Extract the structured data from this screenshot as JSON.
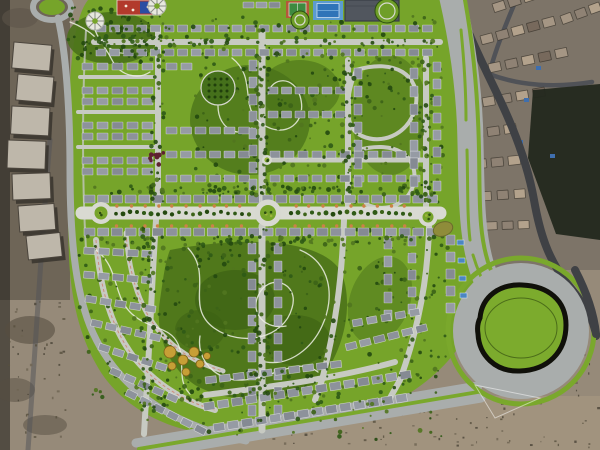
{
  "meta": {
    "subject": "Aerial masterplan rendering of a gated residential compound over desert satellite imagery",
    "canvas": {
      "w": 600,
      "h": 450
    }
  },
  "palette": {
    "sand": "#968a79",
    "sand-dark": "#6e6557",
    "sand-light": "#a3947f",
    "asphalt": "#3f4145",
    "satroad": "#505257",
    "plan": "#76a42a",
    "plan-dark": "#4a7119",
    "plan-darker": "#3c6114",
    "verge": "#7aa82c",
    "road": "#a9adac",
    "street": "#c7cac2",
    "blvd": "#d9dad2",
    "building": "#8d929b",
    "pool-blue": "#4b86c2",
    "court-green": "#3e8a40",
    "court-clay": "#b4583a",
    "playground-red": "#b23a2c",
    "playground-blue": "#2b4ea2",
    "golden-tree": "#c79f36",
    "maroon-tree": "#5f2130",
    "pond-khaki": "#8f8c3a",
    "island-outline": "#10100a",
    "clubhouse": "#51565e"
  },
  "map": {
    "regions": [
      "desert-satellite-backdrop",
      "existing-buildings-west",
      "existing-neighborhood-northeast",
      "masterplan-compound",
      "perimeter-ring-road",
      "east-access-road",
      "main-boulevard",
      "west-roundabout",
      "central-roundabout",
      "east-roundabout",
      "grand-roundabout-southeast",
      "bottom-boulevard",
      "north-park",
      "central-park",
      "southwest-park",
      "sports-courts",
      "playground",
      "clubhouse",
      "residential-block-rows"
    ],
    "building_fills": [
      "#8d929b",
      "#969ba4",
      "#858a93"
    ],
    "sat_house_fills": [
      "#a59684",
      "#8f8274",
      "#b3a28c",
      "#77695c"
    ],
    "tree_colors": [
      "#24490f",
      "#2f5a16",
      "#3c6317",
      "#51751f"
    ],
    "speckle_colors": [
      "#57503f",
      "#6e6452",
      "#4a4437"
    ],
    "building_rows": [
      {
        "x": 96,
        "y": 25,
        "n": 25,
        "dx": 13.6,
        "w": 10,
        "h": 7
      },
      {
        "x": 96,
        "y": 49,
        "n": 25,
        "dx": 13.6,
        "w": 10,
        "h": 7
      },
      {
        "x": 243,
        "y": 2,
        "n": 3,
        "dx": 13,
        "w": 11,
        "h": 6
      },
      {
        "x": 82,
        "y": 63,
        "n": 5,
        "dx": 15,
        "w": 11,
        "h": 7
      },
      {
        "x": 82,
        "y": 87,
        "n": 5,
        "dx": 15,
        "w": 11,
        "h": 7
      },
      {
        "x": 82,
        "y": 98,
        "n": 5,
        "dx": 15,
        "w": 11,
        "h": 7
      },
      {
        "x": 82,
        "y": 122,
        "n": 5,
        "dx": 15,
        "w": 11,
        "h": 7
      },
      {
        "x": 82,
        "y": 133,
        "n": 5,
        "dx": 15,
        "w": 11,
        "h": 7
      },
      {
        "x": 82,
        "y": 157,
        "n": 5,
        "dx": 15,
        "w": 11,
        "h": 7
      },
      {
        "x": 82,
        "y": 168,
        "n": 5,
        "dx": 15,
        "w": 11,
        "h": 7
      },
      {
        "x": 166,
        "y": 63,
        "n": 2,
        "dx": 15,
        "w": 11,
        "h": 7
      },
      {
        "x": 166,
        "y": 127,
        "n": 6,
        "dx": 14.5,
        "w": 11,
        "h": 7
      },
      {
        "x": 166,
        "y": 151,
        "n": 6,
        "dx": 14.5,
        "w": 11,
        "h": 7
      },
      {
        "x": 166,
        "y": 175,
        "n": 6,
        "dx": 14.5,
        "w": 11,
        "h": 7
      },
      {
        "x": 268,
        "y": 87,
        "n": 6,
        "dx": 13.5,
        "w": 10,
        "h": 7
      },
      {
        "x": 268,
        "y": 111,
        "n": 6,
        "dx": 13.5,
        "w": 10,
        "h": 7
      },
      {
        "x": 270,
        "y": 151,
        "n": 11,
        "dx": 14,
        "w": 10,
        "h": 7
      },
      {
        "x": 270,
        "y": 175,
        "n": 11,
        "dx": 14,
        "w": 10,
        "h": 7
      },
      {
        "x": 249,
        "y": 60,
        "n": 8,
        "dy": 17,
        "w": 8,
        "h": 11
      },
      {
        "x": 354,
        "y": 68,
        "n": 7,
        "dy": 18,
        "w": 8,
        "h": 11
      },
      {
        "x": 410,
        "y": 68,
        "n": 7,
        "dy": 18,
        "w": 8,
        "h": 11
      },
      {
        "x": 433,
        "y": 62,
        "n": 8,
        "dy": 17,
        "w": 8,
        "h": 10
      },
      {
        "x": 84,
        "y": 195,
        "n": 26,
        "dx": 13.7,
        "w": 11,
        "h": 8
      },
      {
        "x": 84,
        "y": 228,
        "n": 26,
        "dx": 13.7,
        "w": 11,
        "h": 8
      },
      {
        "x": 248,
        "y": 243,
        "n": 10,
        "dy": 18,
        "w": 8,
        "h": 11
      },
      {
        "x": 274,
        "y": 243,
        "n": 10,
        "dy": 18,
        "w": 8,
        "h": 11
      },
      {
        "x": 384,
        "y": 238,
        "n": 5,
        "dy": 18,
        "w": 8,
        "h": 11
      },
      {
        "x": 408,
        "y": 236,
        "n": 5,
        "dy": 17,
        "w": 8,
        "h": 10
      },
      {
        "x": 446,
        "y": 235,
        "n": 5,
        "dy": 17,
        "w": 9,
        "h": 10
      },
      {
        "x": 84,
        "y": 247,
        "n": 5,
        "dx": 14.5,
        "w": 11,
        "h": 7,
        "rot": 3
      },
      {
        "x": 84,
        "y": 271,
        "n": 5,
        "dx": 14.5,
        "w": 11,
        "h": 7,
        "rot": 5
      },
      {
        "x": 86,
        "y": 295,
        "n": 5,
        "dx": 15,
        "w": 11,
        "h": 7,
        "rot": 9
      },
      {
        "x": 92,
        "y": 319,
        "n": 5,
        "dx": 15,
        "w": 11,
        "h": 7,
        "rot": 13
      },
      {
        "x": 100,
        "y": 343,
        "n": 5,
        "dx": 15,
        "w": 11,
        "h": 7,
        "rot": 18
      },
      {
        "x": 112,
        "y": 367,
        "n": 5,
        "dx": 15.5,
        "w": 11,
        "h": 7,
        "rot": 24
      },
      {
        "x": 128,
        "y": 389,
        "n": 6,
        "dx": 15.5,
        "w": 11,
        "h": 7,
        "rot": 27
      },
      {
        "x": 205,
        "y": 377,
        "n": 10,
        "dx": 14,
        "w": 11,
        "h": 7,
        "rot": -7
      },
      {
        "x": 203,
        "y": 403,
        "n": 15,
        "dx": 14.2,
        "w": 11,
        "h": 8,
        "rot": -9
      },
      {
        "x": 213,
        "y": 424,
        "n": 14,
        "dx": 14.2,
        "w": 11,
        "h": 8,
        "rot": -9
      },
      {
        "x": 345,
        "y": 344,
        "n": 6,
        "dx": 14.5,
        "w": 11,
        "h": 7,
        "rot": -14
      },
      {
        "x": 352,
        "y": 320,
        "n": 5,
        "dx": 14.5,
        "w": 10,
        "h": 7,
        "rot": -10
      },
      {
        "x": 492,
        "y": 4,
        "n": 6,
        "dx": 16,
        "w": 12,
        "h": 9,
        "rot": -18,
        "sat": 1
      },
      {
        "x": 480,
        "y": 36,
        "n": 5,
        "dx": 16,
        "w": 12,
        "h": 9,
        "rot": -15,
        "sat": 1
      },
      {
        "x": 488,
        "y": 64,
        "n": 5,
        "dx": 17,
        "w": 12,
        "h": 9,
        "rot": -12,
        "sat": 1
      },
      {
        "x": 482,
        "y": 98,
        "n": 4,
        "dx": 17,
        "w": 12,
        "h": 9,
        "rot": -10,
        "sat": 1
      },
      {
        "x": 560,
        "y": 16,
        "n": 3,
        "dx": 15,
        "w": 11,
        "h": 9,
        "rot": -20,
        "sat": 1
      },
      {
        "x": 470,
        "y": 130,
        "n": 3,
        "dx": 17,
        "w": 12,
        "h": 9,
        "rot": -8,
        "sat": 1
      },
      {
        "x": 474,
        "y": 160,
        "n": 3,
        "dx": 17,
        "w": 12,
        "h": 9,
        "rot": -6,
        "sat": 1
      },
      {
        "x": 480,
        "y": 192,
        "n": 3,
        "dx": 17,
        "w": 11,
        "h": 9,
        "rot": -4,
        "sat": 1
      },
      {
        "x": 486,
        "y": 222,
        "n": 3,
        "dx": 16,
        "w": 11,
        "h": 8,
        "rot": -2,
        "sat": 1
      }
    ],
    "sat_buildings": [
      {
        "x": 14,
        "y": 42,
        "w": 38,
        "h": 26,
        "rot": 5
      },
      {
        "x": 18,
        "y": 74,
        "w": 36,
        "h": 26,
        "rot": 5
      },
      {
        "x": 12,
        "y": 106,
        "w": 38,
        "h": 28,
        "rot": 3
      },
      {
        "x": 8,
        "y": 140,
        "w": 38,
        "h": 28,
        "rot": 2
      },
      {
        "x": 12,
        "y": 174,
        "w": 38,
        "h": 26,
        "rot": -2
      },
      {
        "x": 18,
        "y": 206,
        "w": 36,
        "h": 26,
        "rot": -4
      },
      {
        "x": 26,
        "y": 236,
        "w": 34,
        "h": 24,
        "rot": -6
      }
    ],
    "tree_clusters": [
      {
        "x": 68,
        "y": 6,
        "w": 95,
        "h": 58,
        "n": 70,
        "dark": 1
      },
      {
        "x": 195,
        "y": 52,
        "w": 150,
        "h": 150,
        "n": 130
      },
      {
        "x": 348,
        "y": 52,
        "w": 95,
        "h": 155,
        "n": 100
      },
      {
        "x": 158,
        "y": 238,
        "w": 190,
        "h": 170,
        "n": 170
      },
      {
        "x": 76,
        "y": 238,
        "w": 125,
        "h": 165,
        "n": 90
      },
      {
        "x": 348,
        "y": 228,
        "w": 100,
        "h": 135,
        "n": 80
      },
      {
        "x": 88,
        "y": 16,
        "w": 350,
        "h": 42,
        "n": 90,
        "over": 1
      },
      {
        "x": 196,
        "y": 368,
        "w": 250,
        "h": 72,
        "n": 80,
        "over": 1
      },
      {
        "x": 80,
        "y": 186,
        "w": 360,
        "h": 9,
        "n": 70,
        "over": 1
      },
      {
        "x": 80,
        "y": 236,
        "w": 360,
        "h": 9,
        "n": 70,
        "over": 1
      },
      {
        "x": 151,
        "y": 26,
        "w": 13,
        "h": 180,
        "n": 40,
        "over": 1
      },
      {
        "x": 256,
        "y": 26,
        "w": 13,
        "h": 178,
        "n": 40,
        "over": 1
      },
      {
        "x": 341,
        "y": 58,
        "w": 13,
        "h": 148,
        "n": 32,
        "over": 1
      },
      {
        "x": 419,
        "y": 56,
        "w": 13,
        "h": 150,
        "n": 32,
        "over": 1
      },
      {
        "x": 140,
        "y": 222,
        "w": 14,
        "h": 210,
        "n": 45,
        "over": 1
      },
      {
        "x": 255,
        "y": 222,
        "w": 14,
        "h": 205,
        "n": 45,
        "over": 1
      },
      {
        "x": 88,
        "y": 38,
        "w": 350,
        "h": 9,
        "n": 50,
        "over": 1
      }
    ],
    "median_trees": {
      "x1": 88,
      "x2": 436,
      "y": 213,
      "step": 7,
      "skip": [
        [
          101,
          15
        ],
        [
          268,
          17
        ],
        [
          428,
          13
        ]
      ]
    },
    "accents": {
      "x1": 90,
      "x2": 436,
      "y1": 206,
      "y2": 226,
      "step": 13.7,
      "color": "#cd8148",
      "skip": [
        [
          101,
          15
        ],
        [
          268,
          17
        ],
        [
          428,
          13
        ]
      ]
    },
    "pools": [
      {
        "x": 457,
        "y": 240
      },
      {
        "x": 458,
        "y": 258
      },
      {
        "x": 459,
        "y": 276
      },
      {
        "x": 460,
        "y": 293
      }
    ],
    "sat_pools": [
      {
        "x": 536,
        "y": 66
      },
      {
        "x": 524,
        "y": 98
      },
      {
        "x": 518,
        "y": 140
      },
      {
        "x": 550,
        "y": 154
      },
      {
        "x": 470,
        "y": 52
      }
    ],
    "golden_trees": [
      {
        "x": 170,
        "y": 352,
        "r": 6
      },
      {
        "x": 183,
        "y": 360,
        "r": 5
      },
      {
        "x": 172,
        "y": 366,
        "r": 4
      },
      {
        "x": 194,
        "y": 352,
        "r": 5
      },
      {
        "x": 200,
        "y": 364,
        "r": 4
      },
      {
        "x": 186,
        "y": 372,
        "r": 4
      },
      {
        "x": 207,
        "y": 356,
        "r": 3.5
      }
    ],
    "maroon_cluster": {
      "x": 150,
      "y": 152,
      "w": 16,
      "h": 14,
      "n": 9
    },
    "speckles": [
      {
        "x": 235,
        "y": 400,
        "w": 290,
        "h": 46,
        "n": 70
      },
      {
        "x": 528,
        "y": 352,
        "w": 70,
        "h": 95,
        "n": 30
      },
      {
        "x": 5,
        "y": 300,
        "w": 60,
        "h": 140,
        "n": 40
      }
    ],
    "roundabouts": [
      {
        "cx": 101,
        "cy": 213,
        "r": 11,
        "ir": 6.5
      },
      {
        "cx": 268,
        "cy": 213,
        "r": 13.5,
        "ir": 8
      },
      {
        "cx": 428,
        "cy": 217,
        "r": 9.5,
        "ir": 5.5
      },
      {
        "cx": 267,
        "cy": 160,
        "r": 5,
        "ir": 2.5
      }
    ],
    "plazas": [
      {
        "cx": 95,
        "cy": 21,
        "r": 9
      },
      {
        "cx": 157,
        "cy": 6,
        "r": 9
      }
    ],
    "green_circles": [
      {
        "cx": 387,
        "cy": 11,
        "r": 12
      },
      {
        "cx": 300,
        "cy": 20,
        "r": 9
      }
    ],
    "round_garden": {
      "cx": 218,
      "cy": 88,
      "r": 17
    },
    "grand_roundabout": {
      "cx": 521,
      "cy": 331,
      "r": 68,
      "ring_r": 73
    }
  }
}
